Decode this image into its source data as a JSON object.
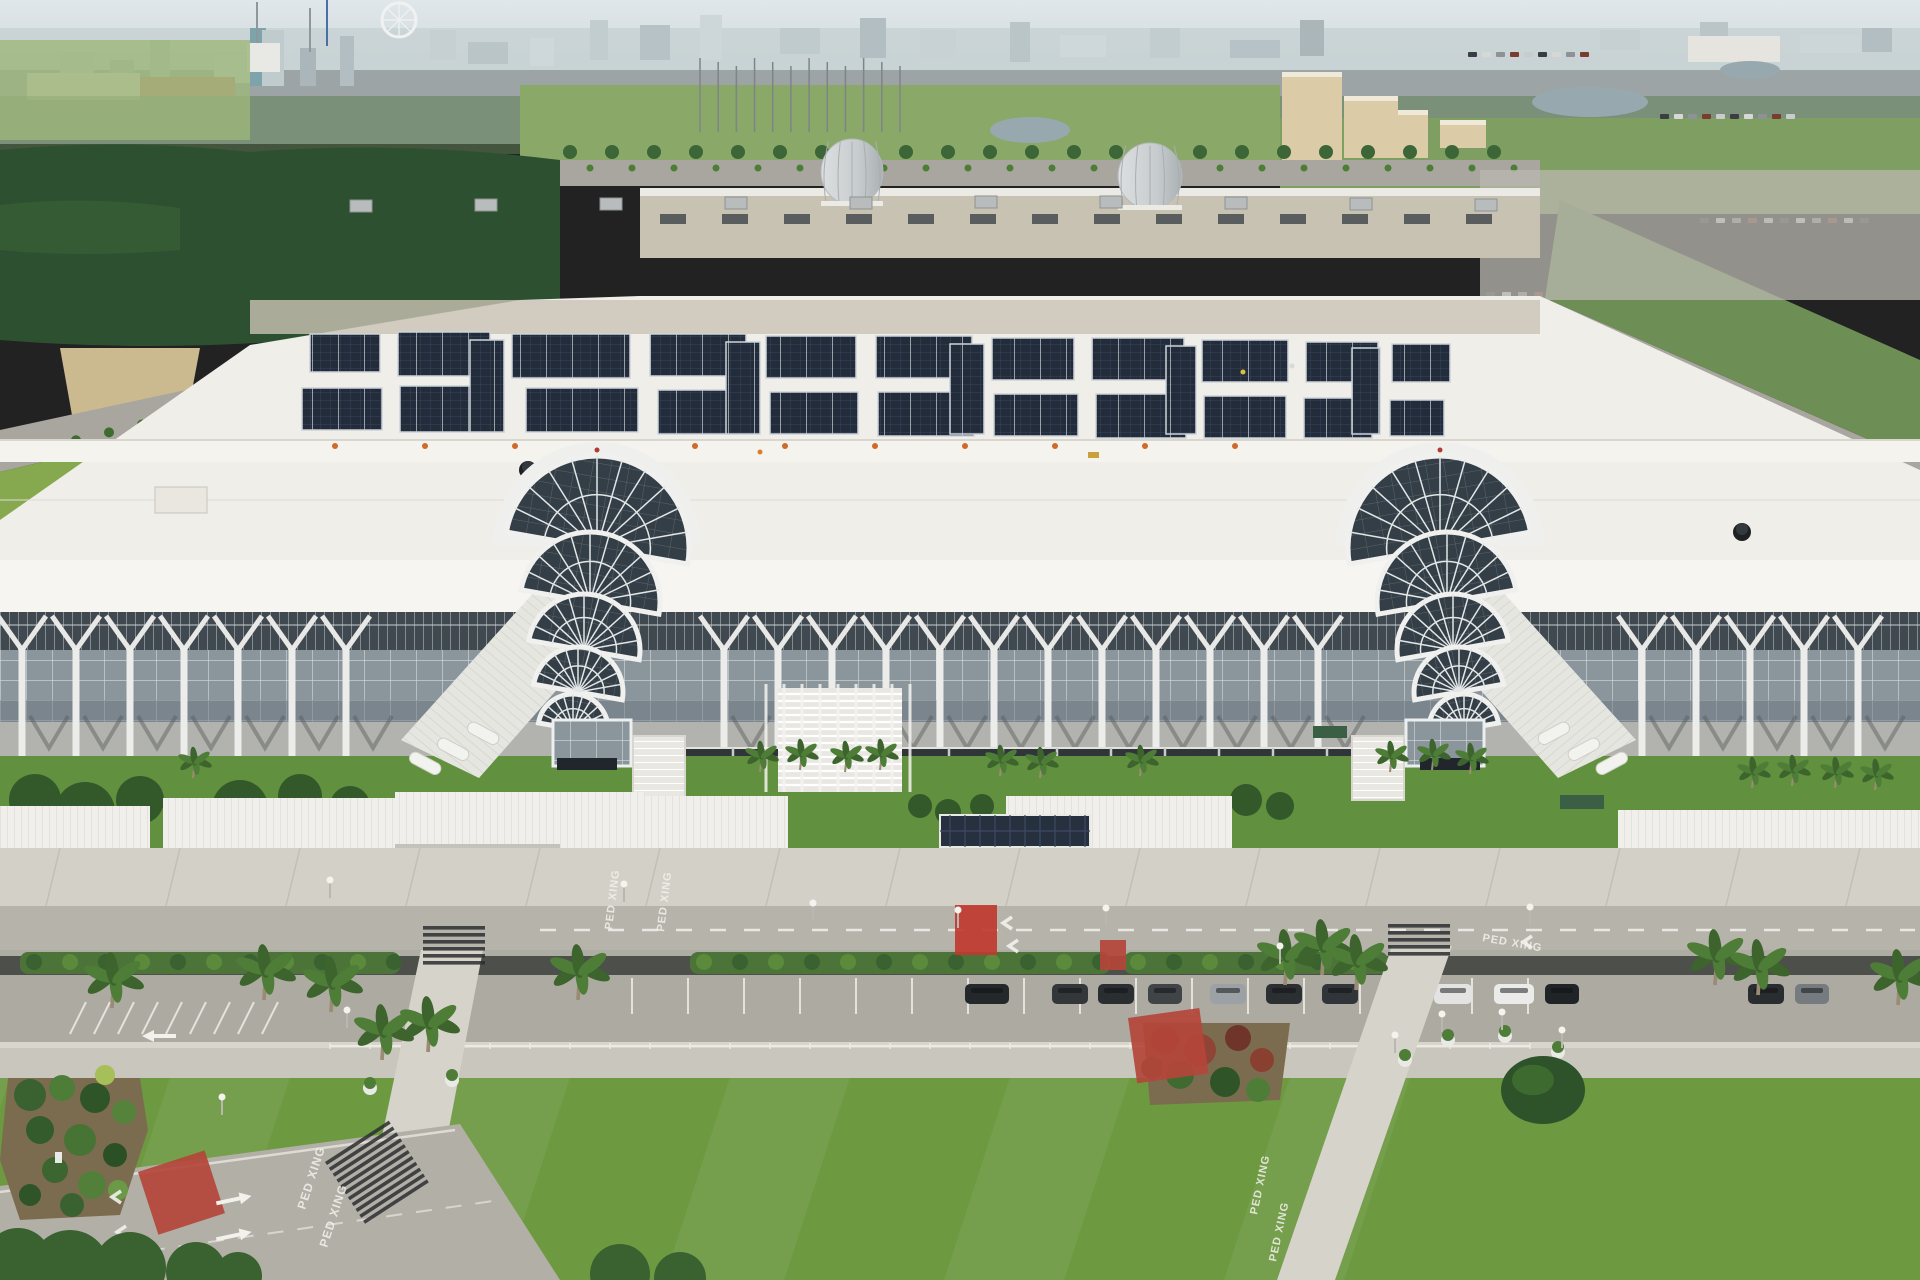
{
  "palette": {
    "sky_top": "#e0e7ea",
    "sky_bottom": "#d2dcdf",
    "city_block": "#c2cdd0",
    "city_trees": "#5f7f53",
    "forest": "#2d5130",
    "field": "#9db77a",
    "meadow": "#8aa868",
    "bright_grass": "#86a94f",
    "roof_white": "#efeee9",
    "roof_bright": "#f6f5f1",
    "wall_beige": "#c8c2b2",
    "vent_dark": "#5a5d5e",
    "solar_dark": "#222c3a",
    "solar_line": "#39455c",
    "solar_frame": "#cdd3da",
    "clerestory": "#414950",
    "glass": "#8a959c",
    "glass_line": "#d6dbde",
    "fan_glass": "#333e46",
    "column_white": "#ececea",
    "dock_dark": "#30353a",
    "door_dark": "#171a1e",
    "concrete": "#d3d0c7",
    "road": "#b6b3ab",
    "road_low": "#b2afa7",
    "lawn": "#6d9a41",
    "lawn_strip": "#61903e",
    "hedge": "#3f6b31",
    "mulch": "#7b6c50",
    "red_paint": "#b4453a",
    "red_crosswalk": "#c0392f",
    "pond": "#97a9ae",
    "hotel_tan": "#dbcba6",
    "palm_green": "#4e7d38",
    "canopy_white": "#f0efeb",
    "stripe_white": "#f2f1ec",
    "cone_orange": "#d06a2a"
  },
  "markings": {
    "label": "PED XING",
    "instances": [
      {
        "x": 612,
        "y": 930,
        "rot": -83,
        "size": 11
      },
      {
        "x": 664,
        "y": 932,
        "rot": -83,
        "size": 11
      },
      {
        "x": 1482,
        "y": 941,
        "rot": 10,
        "size": 11
      },
      {
        "x": 305,
        "y": 1210,
        "rot": -72,
        "size": 12
      },
      {
        "x": 327,
        "y": 1248,
        "rot": -72,
        "size": 12
      },
      {
        "x": 1257,
        "y": 1215,
        "rot": -78,
        "size": 11
      },
      {
        "x": 1276,
        "y": 1262,
        "rot": -78,
        "size": 11
      }
    ],
    "chevrons": [
      [
        1003,
        917
      ],
      [
        1009,
        940
      ],
      [
        1523,
        936
      ],
      [
        112,
        1191
      ],
      [
        117,
        1226
      ]
    ],
    "straight_arrows": [
      [
        232,
        1200,
        -12
      ],
      [
        232,
        1236,
        -12
      ]
    ],
    "left_arrow": [
      160,
      1036
    ],
    "red_patches": [
      {
        "x": 955,
        "y": 905,
        "w": 42,
        "h": 50,
        "rot": 0,
        "bright": true
      },
      {
        "x": 1100,
        "y": 940,
        "w": 26,
        "h": 30,
        "rot": 0,
        "bright": false
      },
      {
        "x": 1128,
        "y": 1018,
        "w": 72,
        "h": 66,
        "rot": -8,
        "bright": false
      },
      {
        "x": 138,
        "y": 1172,
        "w": 70,
        "h": 66,
        "rot": -18,
        "bright": false
      }
    ],
    "zebras": [
      {
        "x": 423,
        "y": 926,
        "w": 62,
        "n": 6
      },
      {
        "x": 1388,
        "y": 924,
        "w": 62,
        "n": 5
      },
      {
        "x": 325,
        "y": 1162,
        "w": 76,
        "n": 11,
        "rot": -33
      }
    ]
  },
  "skyline": {
    "buildings": [
      [
        60,
        52,
        34,
        30,
        "#c2cdd0"
      ],
      [
        110,
        60,
        24,
        24,
        "#aebabd"
      ],
      [
        150,
        40,
        20,
        44,
        "#b6c2c5"
      ],
      [
        214,
        55,
        40,
        28,
        "#ccd5d7"
      ],
      [
        250,
        28,
        16,
        58,
        "#7fa3ab"
      ],
      [
        262,
        30,
        22,
        56,
        "#c0cbce"
      ],
      [
        300,
        48,
        16,
        38,
        "#aab6b9"
      ],
      [
        340,
        36,
        14,
        50,
        "#b2bec1"
      ],
      [
        430,
        30,
        26,
        30,
        "#c6d0d2"
      ],
      [
        468,
        42,
        40,
        22,
        "#bac5c8"
      ],
      [
        530,
        38,
        24,
        28,
        "#ced7d9"
      ],
      [
        590,
        20,
        18,
        40,
        "#c2cdd0"
      ],
      [
        640,
        25,
        30,
        35,
        "#b6c2c5"
      ],
      [
        700,
        15,
        22,
        45,
        "#cdd6d8"
      ],
      [
        780,
        28,
        40,
        26,
        "#c0cbce"
      ],
      [
        860,
        18,
        26,
        40,
        "#b2bec1"
      ],
      [
        920,
        30,
        36,
        28,
        "#c8d2d4"
      ],
      [
        1010,
        22,
        20,
        40,
        "#bac5c8"
      ],
      [
        1060,
        35,
        46,
        22,
        "#ced7d9"
      ],
      [
        1150,
        28,
        30,
        30,
        "#c2cdd0"
      ],
      [
        1230,
        40,
        50,
        18,
        "#b6c2c5"
      ],
      [
        1300,
        20,
        24,
        36,
        "#aab6b9"
      ],
      [
        1600,
        30,
        40,
        20,
        "#c6d0d2"
      ],
      [
        1700,
        22,
        28,
        26,
        "#bac5c8"
      ],
      [
        1800,
        35,
        60,
        18,
        "#ccd5d7"
      ],
      [
        1862,
        28,
        30,
        24,
        "#b2bec1"
      ]
    ],
    "towers": [
      [
        257,
        2,
        46,
        "#8d989b"
      ],
      [
        310,
        8,
        44,
        "#8d989b"
      ],
      [
        327,
        0,
        46,
        "#4a6fa5"
      ]
    ],
    "ferris_wheel": {
      "cx": 399,
      "cy": 20,
      "r": 17
    },
    "landmarks": {
      "church": [
        247,
        43,
        33,
        29,
        "#e8e8e4"
      ],
      "red_roof_row": [
        140,
        77,
        95,
        20,
        "#c0846a"
      ],
      "cream_row": [
        27,
        73,
        113,
        27,
        "#ded8c9"
      ],
      "green_venue": [
        640,
        103,
        120,
        48,
        "#cdd4d0"
      ],
      "white_hotel": [
        1688,
        36,
        92,
        26,
        "#e6e4de"
      ]
    }
  },
  "midground": {
    "golf_poles": {
      "x1": 700,
      "x2": 900,
      "n": 12,
      "y_top": 58,
      "y_bot": 132
    },
    "ponds": [
      [
        1030,
        130,
        40,
        13
      ],
      [
        1452,
        208,
        48,
        13
      ],
      [
        1590,
        102,
        58,
        15
      ],
      [
        1750,
        70,
        30,
        9
      ]
    ],
    "hotels": [
      [
        1282,
        72,
        60,
        88
      ],
      [
        1344,
        96,
        54,
        62
      ],
      [
        1398,
        110,
        30,
        48
      ],
      [
        1440,
        120,
        46,
        28
      ]
    ],
    "lot_speck_rows": [
      {
        "x1": 1468,
        "y": 52,
        "n": 9,
        "step": 14
      },
      {
        "x1": 1660,
        "y": 114,
        "n": 10,
        "step": 14
      },
      {
        "x1": 1700,
        "y": 218,
        "n": 11,
        "step": 16
      },
      {
        "x1": 1486,
        "y": 292,
        "n": 5,
        "step": 16
      }
    ],
    "speck_colors": [
      "#3a3e42",
      "#d7d7d5",
      "#8e9297",
      "#7a3c31",
      "#c9cccd"
    ]
  },
  "building": {
    "domes": [
      {
        "cx": 852,
        "cy": 172,
        "rx": 31,
        "ry": 33
      },
      {
        "cx": 1150,
        "cy": 176,
        "rx": 32,
        "ry": 33
      }
    ],
    "back_vents": {
      "x1": 660,
      "x2": 1500,
      "step": 62,
      "y": 214,
      "w": 26,
      "h": 10
    },
    "rooftop_units": [
      [
        350,
        200
      ],
      [
        475,
        199
      ],
      [
        600,
        198
      ],
      [
        725,
        197
      ],
      [
        850,
        197
      ],
      [
        975,
        196
      ],
      [
        1100,
        196
      ],
      [
        1225,
        197
      ],
      [
        1350,
        198
      ],
      [
        1475,
        199
      ]
    ],
    "black_vents": [
      [
        418,
        594
      ],
      [
        910,
        590
      ],
      [
        1742,
        532
      ],
      [
        528,
        470
      ]
    ],
    "cream_box": [
      155,
      487,
      52,
      26
    ],
    "cones": {
      "y": 446,
      "xs": [
        335,
        425,
        515,
        605,
        695,
        785,
        875,
        965,
        1055,
        1145,
        1235
      ]
    },
    "cart": [
      1088,
      452
    ],
    "workers": [
      [
        1243,
        372,
        "#d6c23c"
      ],
      [
        1292,
        366,
        "#d9d9d9"
      ],
      [
        760,
        452,
        "#d77f2f"
      ]
    ],
    "solar_blocks": [
      [
        310,
        334,
        70,
        38
      ],
      [
        398,
        332,
        92,
        44
      ],
      [
        512,
        334,
        118,
        44
      ],
      [
        650,
        334,
        96,
        42
      ],
      [
        766,
        336,
        90,
        42
      ],
      [
        876,
        336,
        96,
        42
      ],
      [
        992,
        338,
        82,
        42
      ],
      [
        1092,
        338,
        92,
        42
      ],
      [
        1202,
        340,
        86,
        42
      ],
      [
        1306,
        342,
        72,
        40
      ],
      [
        1392,
        344,
        58,
        38
      ],
      [
        302,
        388,
        80,
        42
      ],
      [
        400,
        386,
        104,
        46
      ],
      [
        526,
        388,
        112,
        44
      ],
      [
        658,
        390,
        94,
        44
      ],
      [
        770,
        392,
        88,
        42
      ],
      [
        878,
        392,
        96,
        44
      ],
      [
        994,
        394,
        84,
        42
      ],
      [
        1096,
        394,
        90,
        44
      ],
      [
        1204,
        396,
        82,
        42
      ],
      [
        1304,
        398,
        68,
        40
      ],
      [
        1390,
        400,
        54,
        36
      ],
      [
        470,
        340,
        34,
        92
      ],
      [
        726,
        342,
        34,
        92
      ],
      [
        950,
        344,
        34,
        90
      ],
      [
        1166,
        346,
        30,
        88
      ],
      [
        1352,
        348,
        28,
        86
      ]
    ],
    "facade": {
      "start": 22,
      "end": 1898,
      "step": 54,
      "skips": [
        [
          395,
          700
        ],
        [
          1325,
          1625
        ]
      ]
    },
    "dock": {
      "x": 618,
      "y": 748,
      "w": 786,
      "h": 44,
      "door_step": 54,
      "door_w": 26,
      "door_h": 30
    },
    "atria": [
      {
        "cx": 597,
        "top": 440,
        "mirror": true
      },
      {
        "cx": 1440,
        "top": 440,
        "mirror": false
      }
    ],
    "canopies": [
      {
        "x": 0,
        "y": 806,
        "w": 150,
        "h": 56
      },
      {
        "x": 163,
        "y": 798,
        "w": 260,
        "h": 60
      },
      {
        "x": 395,
        "y": 792,
        "w": 250,
        "h": 58
      },
      {
        "x": 560,
        "y": 796,
        "w": 228,
        "h": 58
      },
      {
        "x": 1006,
        "y": 796,
        "w": 226,
        "h": 58
      },
      {
        "x": 1618,
        "y": 810,
        "w": 302,
        "h": 58
      }
    ],
    "solar_canopy": {
      "x": 940,
      "y": 815,
      "w": 150,
      "h": 32
    },
    "green_awnings": [
      [
        1313,
        726,
        34,
        12
      ],
      [
        1560,
        795,
        44,
        14
      ]
    ],
    "grand_stair": {
      "x": 778,
      "y": 688,
      "w": 124,
      "h": 104
    }
  },
  "grounds": {
    "small_palms": [
      [
        193,
        778
      ],
      [
        760,
        772
      ],
      [
        800,
        770
      ],
      [
        845,
        772
      ],
      [
        880,
        770
      ],
      [
        1000,
        776
      ],
      [
        1040,
        778
      ],
      [
        1140,
        776
      ],
      [
        1390,
        772
      ],
      [
        1432,
        770
      ],
      [
        1470,
        774
      ],
      [
        1752,
        788
      ],
      [
        1792,
        786
      ],
      [
        1835,
        788
      ],
      [
        1875,
        790
      ]
    ],
    "front_bushes": [
      [
        920,
        806,
        12
      ],
      [
        948,
        812,
        13
      ],
      [
        982,
        806,
        12
      ],
      [
        1246,
        800,
        16
      ],
      [
        1280,
        806,
        14
      ],
      [
        35,
        800,
        26
      ],
      [
        85,
        812,
        30
      ],
      [
        140,
        800,
        24
      ],
      [
        240,
        808,
        28
      ],
      [
        300,
        796,
        22
      ],
      [
        350,
        806,
        20
      ]
    ],
    "big_palms": [
      [
        112,
        1008
      ],
      [
        264,
        1000
      ],
      [
        331,
        1012
      ],
      [
        578,
        1000
      ],
      [
        382,
        1060
      ],
      [
        428,
        1052
      ],
      [
        1285,
        985
      ],
      [
        1322,
        975
      ],
      [
        1356,
        990
      ],
      [
        1715,
        985
      ],
      [
        1758,
        995
      ],
      [
        1898,
        1005
      ]
    ],
    "cars": [
      {
        "x": 965,
        "w": 44,
        "c": "#25282b"
      },
      {
        "x": 1052,
        "w": 36,
        "c": "#34373a"
      },
      {
        "x": 1098,
        "w": 36,
        "c": "#2b2e31"
      },
      {
        "x": 1148,
        "w": 34,
        "c": "#404447"
      },
      {
        "x": 1210,
        "w": 36,
        "c": "#9ba1a5"
      },
      {
        "x": 1266,
        "w": 36,
        "c": "#2c2f32"
      },
      {
        "x": 1322,
        "w": 36,
        "c": "#313539"
      },
      {
        "x": 1378,
        "w": 36,
        "c": "#8e9599"
      },
      {
        "x": 1434,
        "w": 38,
        "c": "#e3e4e2"
      },
      {
        "x": 1494,
        "w": 40,
        "c": "#ebecea"
      },
      {
        "x": 1545,
        "w": 34,
        "c": "#212427"
      },
      {
        "x": 1748,
        "w": 36,
        "c": "#2a2d30"
      },
      {
        "x": 1795,
        "w": 34,
        "c": "#757b7f"
      }
    ],
    "car_y": 984,
    "poles": [
      [
        813,
        921
      ],
      [
        958,
        928
      ],
      [
        1106,
        926
      ],
      [
        1280,
        964
      ],
      [
        347,
        1028
      ],
      [
        222,
        1115
      ],
      [
        1395,
        1053
      ],
      [
        1442,
        1032
      ],
      [
        1502,
        1030
      ],
      [
        1562,
        1048
      ],
      [
        330,
        898
      ],
      [
        624,
        902
      ],
      [
        1530,
        925
      ]
    ],
    "stall_lines": {
      "x1": 632,
      "x2": 1560,
      "step": 56,
      "y1": 978,
      "y2": 1014
    },
    "angled_stalls": {
      "x1": 70,
      "n": 9,
      "step": 24,
      "y1": 1034,
      "y2": 1002
    },
    "dash_line": {
      "y": 930,
      "x1": 540,
      "x2": 1915
    },
    "fence": {
      "x1": 330,
      "x2": 1530,
      "y": 1046
    },
    "left_garden_bushes": [
      [
        30,
        1095,
        16,
        "#3a6130"
      ],
      [
        62,
        1088,
        13,
        "#4e7d38"
      ],
      [
        95,
        1098,
        15,
        "#2f5428"
      ],
      [
        124,
        1112,
        12,
        "#56833c"
      ],
      [
        40,
        1130,
        14,
        "#345b2c"
      ],
      [
        80,
        1140,
        16,
        "#477434"
      ],
      [
        115,
        1155,
        12,
        "#2c5026"
      ],
      [
        55,
        1170,
        13,
        "#3c6530"
      ],
      [
        92,
        1185,
        14,
        "#52803a"
      ],
      [
        30,
        1195,
        11,
        "#2f5428"
      ],
      [
        118,
        1190,
        10,
        "#6b9a47"
      ],
      [
        72,
        1205,
        12,
        "#3a6130"
      ],
      [
        105,
        1075,
        10,
        "#a7bf58"
      ]
    ],
    "right_garden_shrubs": [
      [
        1165,
        1040,
        14,
        "#7c3a2d"
      ],
      [
        1200,
        1050,
        16,
        "#8f4436"
      ],
      [
        1238,
        1038,
        13,
        "#6f352a"
      ],
      [
        1262,
        1060,
        12,
        "#8a4031"
      ],
      [
        1180,
        1075,
        14,
        "#3f6b31"
      ],
      [
        1225,
        1082,
        15,
        "#2f5428"
      ],
      [
        1258,
        1090,
        12,
        "#4e7d38"
      ],
      [
        1152,
        1068,
        11,
        "#355c2b"
      ]
    ],
    "median_ranges": [
      [
        20,
        400
      ],
      [
        690,
        1110
      ],
      [
        1124,
        1388
      ]
    ],
    "planter_pots": [
      [
        1405,
        1060
      ],
      [
        1448,
        1040
      ],
      [
        1505,
        1036
      ],
      [
        1558,
        1052
      ],
      [
        370,
        1088
      ],
      [
        452,
        1080
      ]
    ],
    "big_bush": {
      "cx": 1543,
      "cy": 1090,
      "rx": 42,
      "ry": 34
    },
    "bottom_trees": [
      [
        18,
        1262,
        34
      ],
      [
        70,
        1270,
        40
      ],
      [
        130,
        1268,
        36
      ],
      [
        196,
        1272,
        30
      ],
      [
        238,
        1276,
        24
      ],
      [
        620,
        1274,
        30
      ],
      [
        680,
        1278,
        26
      ]
    ]
  }
}
